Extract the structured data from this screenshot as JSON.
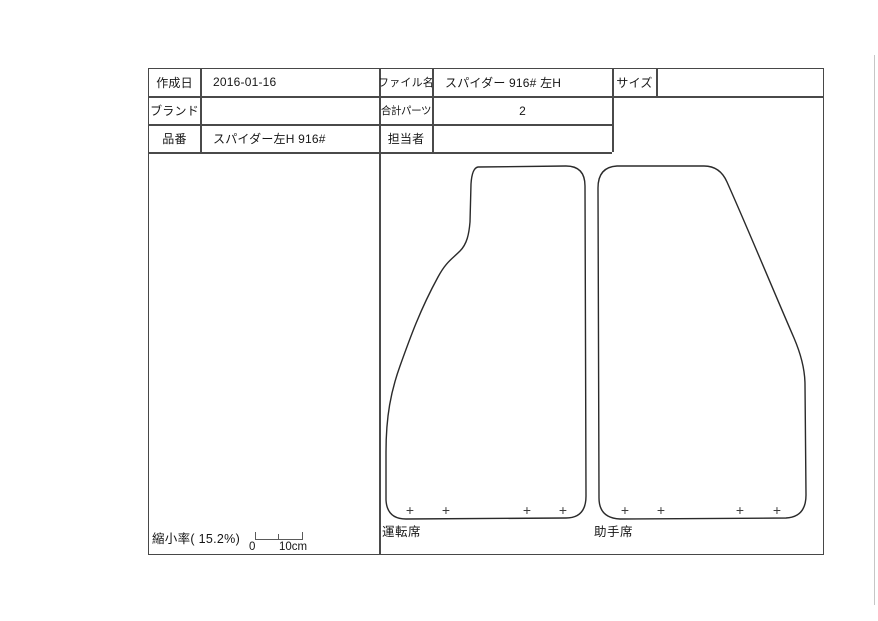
{
  "page": {
    "background": "#ffffff",
    "line_color": "#474747",
    "text_color": "#161616"
  },
  "info_table": {
    "created_date": {
      "label": "作成日",
      "value": "2016-01-16"
    },
    "brand": {
      "label": "ブランド",
      "value": ""
    },
    "part_number": {
      "label": "品番",
      "value": "スパイダー左H 916#"
    },
    "file_name": {
      "label": "ファイル名",
      "value": "スパイダー 916# 左H"
    },
    "total_parts": {
      "label": "合計パーツ",
      "value": "2"
    },
    "person_in_charge": {
      "label": "担当者",
      "value": ""
    },
    "size": {
      "label": "サイズ",
      "value": ""
    }
  },
  "drawing": {
    "marker_glyph": "+",
    "mats": [
      {
        "label": "運転席",
        "marker_count": 4
      },
      {
        "label": "助手席",
        "marker_count": 4
      }
    ]
  },
  "footer": {
    "scale_text": "縮小率( 15.2%)",
    "ruler_zero": "0",
    "ruler_max": "10cm"
  }
}
